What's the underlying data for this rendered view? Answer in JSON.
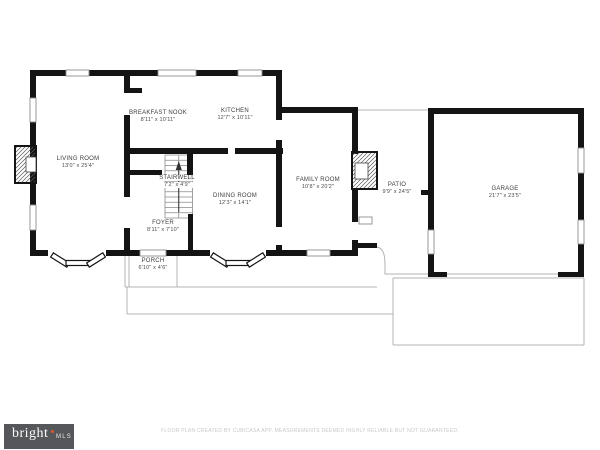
{
  "colors": {
    "wall": "#141414",
    "outline": "#b3b3b3",
    "window_frame": "#8f8f8f",
    "stair_line": "#8a8a8a",
    "arrow": "#333333",
    "logo_bg": "#56575a",
    "logo_dot": "#de5a2c"
  },
  "rooms": [
    {
      "id": "living-room",
      "name": "LIVING ROOM",
      "dims": "13'0\" x 25'4\"",
      "x": 78,
      "y": 156,
      "on_stairs": false
    },
    {
      "id": "breakfast-nook",
      "name": "BREAKFAST NOOK",
      "dims": "8'11\" x 10'11\"",
      "x": 158,
      "y": 110,
      "on_stairs": false
    },
    {
      "id": "kitchen",
      "name": "KITCHEN",
      "dims": "12'7\" x 10'11\"",
      "x": 235,
      "y": 108,
      "on_stairs": false
    },
    {
      "id": "stairwell",
      "name": "STAIRWELL",
      "dims": "7'2\" x 4'9\"",
      "x": 177,
      "y": 175,
      "on_stairs": true
    },
    {
      "id": "dining-room",
      "name": "DINING ROOM",
      "dims": "12'3\" x 14'1\"",
      "x": 235,
      "y": 193,
      "on_stairs": false
    },
    {
      "id": "foyer",
      "name": "FOYER",
      "dims": "8'11\" x 7'10\"",
      "x": 163,
      "y": 220,
      "on_stairs": false
    },
    {
      "id": "family-room",
      "name": "FAMILY ROOM",
      "dims": "10'8\" x 20'2\"",
      "x": 318,
      "y": 177,
      "on_stairs": false
    },
    {
      "id": "patio",
      "name": "PATIO",
      "dims": "9'9\" x 24'5\"",
      "x": 397,
      "y": 182,
      "on_stairs": false
    },
    {
      "id": "garage",
      "name": "GARAGE",
      "dims": "21'7\" x 23'5\"",
      "x": 505,
      "y": 186,
      "on_stairs": false
    },
    {
      "id": "porch",
      "name": "PORCH",
      "dims": "6'10\" x 4'6\"",
      "x": 153,
      "y": 258,
      "on_stairs": false
    }
  ],
  "geometry": {
    "walls": [
      [
        30,
        70,
        252,
        6
      ],
      [
        30,
        70,
        6,
        186
      ],
      [
        30,
        250,
        98,
        6
      ],
      [
        128,
        250,
        230,
        6
      ],
      [
        276,
        70,
        6,
        50
      ],
      [
        276,
        140,
        6,
        14
      ],
      [
        276,
        107,
        82,
        6
      ],
      [
        276,
        154,
        6,
        73
      ],
      [
        276,
        245,
        6,
        11
      ],
      [
        127,
        148,
        101,
        6
      ],
      [
        234,
        148,
        49,
        6
      ],
      [
        127,
        170,
        35,
        5
      ],
      [
        124,
        70,
        6,
        23
      ],
      [
        124,
        88,
        18,
        5
      ],
      [
        124,
        115,
        6,
        82
      ],
      [
        124,
        228,
        6,
        28
      ],
      [
        188,
        214,
        5,
        42
      ],
      [
        187,
        148,
        6,
        32
      ],
      [
        352,
        107,
        6,
        47
      ],
      [
        352,
        189,
        6,
        33
      ],
      [
        352,
        240,
        6,
        10
      ],
      [
        352,
        243,
        25,
        5
      ],
      [
        428,
        108,
        156,
        6
      ],
      [
        428,
        108,
        6,
        169
      ],
      [
        578,
        108,
        6,
        169
      ],
      [
        428,
        272,
        19,
        5
      ],
      [
        558,
        272,
        26,
        5
      ],
      [
        421,
        190,
        7,
        5
      ]
    ],
    "door_gaps": [
      [
        276,
        120,
        6,
        20
      ],
      [
        276,
        227,
        6,
        18
      ],
      [
        228,
        148,
        7,
        6
      ],
      [
        48,
        250,
        58,
        6
      ],
      [
        210,
        250,
        56,
        6
      ],
      [
        352,
        222,
        6,
        18
      ]
    ],
    "windows": [
      [
        66,
        70,
        23,
        6
      ],
      [
        158,
        70,
        38,
        6
      ],
      [
        238,
        70,
        24,
        6
      ],
      [
        30,
        98,
        6,
        24
      ],
      [
        30,
        205,
        6,
        25
      ],
      [
        307,
        250,
        23,
        6
      ],
      [
        140,
        250,
        26,
        6
      ],
      [
        428,
        230,
        6,
        24
      ],
      [
        578,
        148,
        6,
        25
      ],
      [
        578,
        220,
        6,
        24
      ],
      [
        359,
        217,
        13,
        7
      ]
    ],
    "bay_segments": [
      {
        "x": 52,
        "y": 252.5,
        "w": 19,
        "h": 5,
        "rot": 32,
        "px": 52,
        "py": 255
      },
      {
        "x": 66,
        "y": 260.5,
        "w": 24,
        "h": 5,
        "rot": 0,
        "px": 0,
        "py": 0
      },
      {
        "x": 88,
        "y": 262.5,
        "w": 19,
        "h": 5,
        "rot": -32,
        "px": 88,
        "py": 265
      },
      {
        "x": 212,
        "y": 252.5,
        "w": 19,
        "h": 5,
        "rot": 32,
        "px": 212,
        "py": 255
      },
      {
        "x": 226,
        "y": 260.5,
        "w": 26,
        "h": 5,
        "rot": 0,
        "px": 0,
        "py": 0
      },
      {
        "x": 248,
        "y": 262.5,
        "w": 19,
        "h": 5,
        "rot": -32,
        "px": 248,
        "py": 265
      }
    ],
    "fireplaces": [
      {
        "outer": [
          15,
          146,
          21,
          37
        ],
        "inner": [
          26,
          157,
          10,
          15
        ]
      },
      {
        "outer": [
          352,
          152,
          25,
          37
        ],
        "inner": [
          355,
          163,
          13,
          16
        ]
      }
    ],
    "thin_lines": [
      [
        125,
        256,
        125,
        287
      ],
      [
        129,
        256,
        129,
        287
      ],
      [
        177,
        256,
        177,
        287
      ],
      [
        125,
        287,
        377,
        287
      ],
      [
        127,
        287,
        127,
        314
      ],
      [
        127,
        314,
        393,
        314
      ],
      [
        393,
        278,
        393,
        345
      ],
      [
        393,
        278,
        584,
        278
      ],
      [
        584,
        278,
        584,
        345
      ],
      [
        393,
        345,
        584,
        345
      ],
      [
        358,
        110,
        428,
        110
      ],
      [
        447,
        274,
        558,
        274
      ]
    ],
    "curves": [
      "M377,247 C386,249 385,261 385,274 L428,274"
    ],
    "stairs": {
      "x": 165,
      "y": 155,
      "w": 27.5,
      "h": 63,
      "step": 5.25
    },
    "stair_arrow": {
      "x": 178.75,
      "y1": 212,
      "y2": 168,
      "head": "175.7,170 181.8,170 178.75,161"
    }
  },
  "footer": {
    "logo_primary": "bright",
    "logo_secondary": "MLS",
    "disclaimer": "FLOOR PLAN CREATED BY CUBICASA APP. MEASUREMENTS DEEMED HIGHLY RELIABLE BUT NOT GUARANTEED."
  }
}
